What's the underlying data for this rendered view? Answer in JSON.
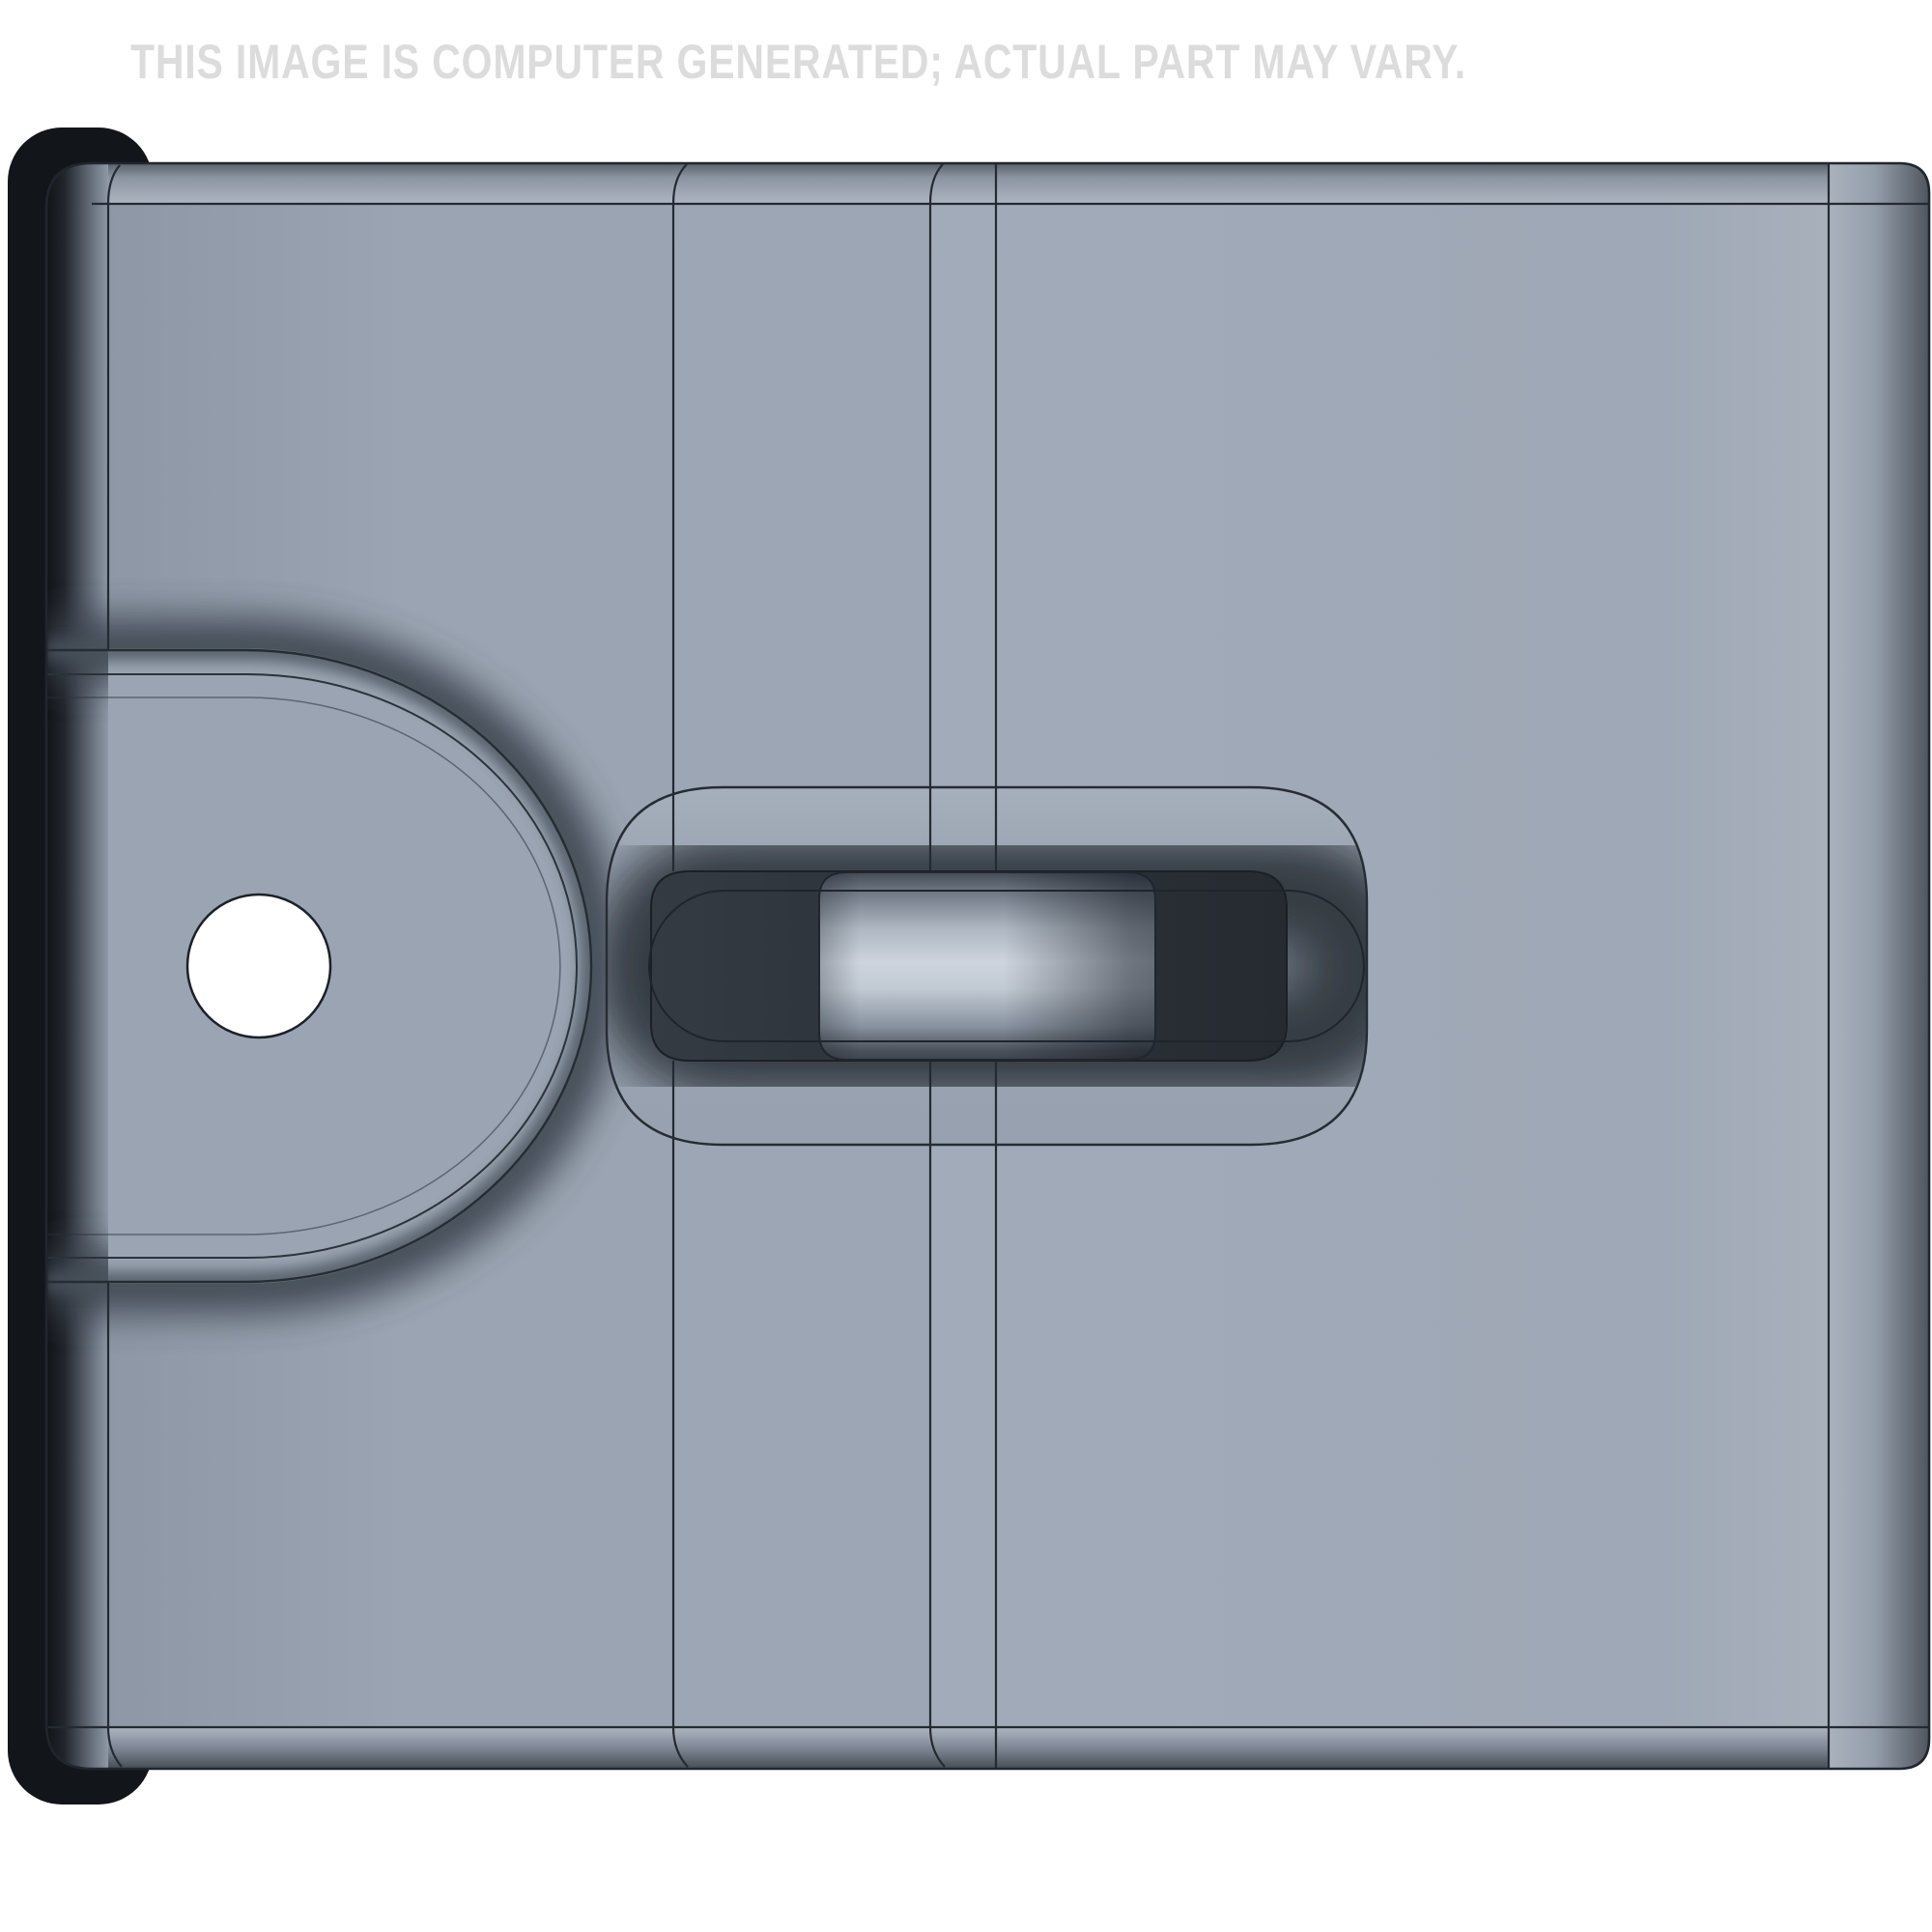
{
  "watermark": {
    "text": "THIS IMAGE IS COMPUTER GENERATED; ACTUAL PART MAY VARY."
  },
  "colors": {
    "background": "#ffffff",
    "watermark_text": "#dcdcdd",
    "plate_face": "#9ba4b2",
    "plate_face_light": "#a4adbb",
    "top_edge_band_dark": "#596069",
    "bottom_edge_band_dark": "#454c55",
    "right_edge_band_dark": "#4f565f",
    "left_edge_shadow": "#101317",
    "backing_black": "#121519",
    "slot_recess": "#2b3138",
    "pin_highlight": "#ccd3dd",
    "pin_edge_dark": "#444b54",
    "tab_hole": "#ffffff",
    "outline": "#242a32"
  }
}
